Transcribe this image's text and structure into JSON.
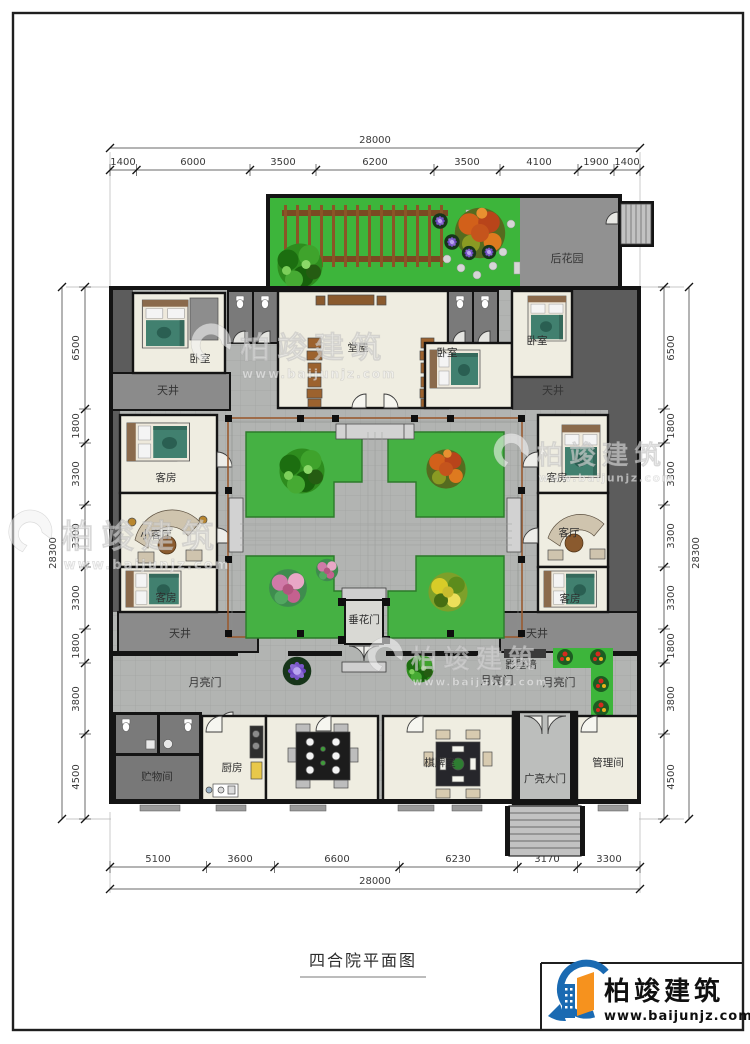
{
  "title": {
    "text": "四合院平面图"
  },
  "logo": {
    "name": "柏竣建筑",
    "url": "www.baijunjz.com"
  },
  "watermark": {
    "name": "柏竣建筑",
    "url": "www.baijunjz.com"
  },
  "dimensions": {
    "top": {
      "total": "28000",
      "segments": [
        "1400",
        "6000",
        "3500",
        "6200",
        "3500",
        "4100",
        "1900",
        "1400"
      ]
    },
    "bottom": {
      "total": "28000",
      "segments": [
        "5100",
        "3600",
        "6600",
        "6230",
        "3170",
        "3300"
      ]
    },
    "left": {
      "total": "28300",
      "segments": [
        "6500",
        "1800",
        "3300",
        "3300",
        "3300",
        "1800",
        "3800",
        "4500"
      ]
    },
    "right": {
      "total": "28300",
      "segments": [
        "6500",
        "1800",
        "3300",
        "3300",
        "3300",
        "1800",
        "3800",
        "4500"
      ]
    }
  },
  "rooms": {
    "back_garden": "后花园",
    "main_hall": "堂屋",
    "bedroom": "卧室",
    "skywell": "天井",
    "guest_room": "客房",
    "small_living_room": "小客厅",
    "living_room": "客厅",
    "festoon_gate": "垂花门",
    "moon_gate": "月亮门",
    "screen_wall": "影壁墙",
    "storage_room": "贮物间",
    "kitchen": "厨房",
    "chess_room": "棋牌室",
    "grand_gate": "广亮大门",
    "management_room": "管理间"
  },
  "colors": {
    "lawn_green": "#3db53b",
    "planter_green": "#45b143",
    "roof_dark_gray": "#5c5c5c",
    "skywell_gray": "#8b8b8b",
    "paving_gray": "#b2b4b2",
    "wall_black": "#141414",
    "pergola_brown": "#8a5526",
    "logo_blue": "#1a6ab2",
    "logo_orange": "#f6921e"
  }
}
